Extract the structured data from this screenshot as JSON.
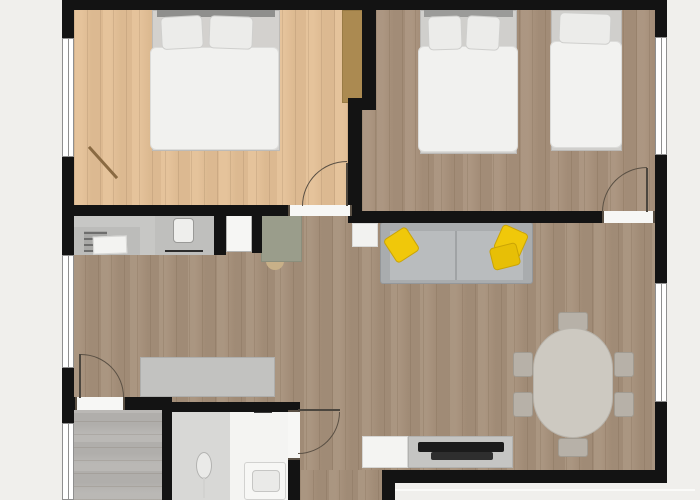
{
  "palette": {
    "background": "#f0efec",
    "wall": "#131313",
    "window_fill": "#ffffff",
    "window_line": "#8f8f8f",
    "threshold_fill": "#f7f7f5",
    "door_line": "#5a5044",
    "floor_wood_light": "#e4c096",
    "floor_wood_dark": "#a6907a",
    "floor_tile_gray": "#b6b4b1",
    "accent_yellow": "#f0c80a"
  },
  "elements": [
    {
      "n": "floor-bedroom-1",
      "t": "floor",
      "x": 74,
      "y": 10,
      "w": 290,
      "h": 196,
      "c": "#e4c096"
    },
    {
      "n": "floor-bedroom-2",
      "t": "floor",
      "x": 376,
      "y": 10,
      "w": 281,
      "h": 203,
      "c": "#a8917b"
    },
    {
      "n": "floor-bedroom-2-strip",
      "t": "floor",
      "x": 362,
      "y": 110,
      "w": 14,
      "h": 103,
      "c": "#a8917b"
    },
    {
      "n": "floor-living-room",
      "t": "floor",
      "x": 72,
      "y": 216,
      "w": 585,
      "h": 254,
      "c": "#a6907a"
    },
    {
      "n": "floor-hallway-strip",
      "t": "floor",
      "x": 300,
      "y": 470,
      "w": 82,
      "h": 30,
      "c": "#a6907a"
    },
    {
      "n": "floor-entry-room",
      "t": "floor",
      "x": 72,
      "y": 410,
      "w": 90,
      "h": 90,
      "c": "#b6b4b1",
      "d": "h"
    },
    {
      "n": "floor-bathroom",
      "t": "rect",
      "x": 172,
      "y": 412,
      "w": 118,
      "h": 88,
      "c": "#d8d8d6"
    },
    {
      "n": "floor-shower-area",
      "t": "rect",
      "x": 230,
      "y": 412,
      "w": 60,
      "h": 88,
      "c": "#f4f4f2"
    },
    {
      "n": "wardrobe",
      "t": "rect",
      "x": 342,
      "y": 10,
      "w": 22,
      "h": 93,
      "c": "#ab8a51",
      "b": "#997b45"
    },
    {
      "n": "double-bed-1-frame",
      "t": "rect",
      "x": 152,
      "y": 10,
      "w": 128,
      "h": 141,
      "c": "#d3d1ce",
      "b": "#bdbbb8"
    },
    {
      "n": "double-bed-1-headboard",
      "t": "rect",
      "x": 157,
      "y": 10,
      "w": 118,
      "h": 7,
      "c": "#8f8f8d"
    },
    {
      "n": "double-bed-1-duvet",
      "t": "rect",
      "x": 150,
      "y": 47,
      "w": 129,
      "h": 103,
      "c": "#f1f1ef",
      "b": "#dcdcda",
      "r": 6
    },
    {
      "n": "double-bed-1-pillow-left",
      "t": "rect",
      "x": 161,
      "y": 16,
      "w": 42,
      "h": 33,
      "c": "#ececea",
      "b": "#cfcfcd",
      "r": 5,
      "rot": -3
    },
    {
      "n": "double-bed-1-pillow-right",
      "t": "rect",
      "x": 209,
      "y": 16,
      "w": 44,
      "h": 33,
      "c": "#ececea",
      "b": "#cfcfcd",
      "r": 5,
      "rot": 2
    },
    {
      "n": "floor-lamp-stick",
      "t": "line",
      "x": 82,
      "y": 161,
      "w": 42,
      "h": 3,
      "c": "#8a6a42",
      "rot": 48
    },
    {
      "n": "double-bed-2-frame",
      "t": "rect",
      "x": 420,
      "y": 10,
      "w": 97,
      "h": 144,
      "c": "#d0cfcc",
      "b": "#bbb9b6"
    },
    {
      "n": "double-bed-2-headboard",
      "t": "rect",
      "x": 424,
      "y": 10,
      "w": 89,
      "h": 7,
      "c": "#9b9b99"
    },
    {
      "n": "double-bed-2-duvet",
      "t": "rect",
      "x": 418,
      "y": 46,
      "w": 100,
      "h": 106,
      "c": "#f1f1ef",
      "b": "#dcdcda",
      "r": 6
    },
    {
      "n": "double-bed-2-pillow-left",
      "t": "rect",
      "x": 428,
      "y": 16,
      "w": 34,
      "h": 34,
      "c": "#ececea",
      "b": "#cfcfcd",
      "r": 5,
      "rot": -2
    },
    {
      "n": "double-bed-2-pillow-right",
      "t": "rect",
      "x": 466,
      "y": 16,
      "w": 34,
      "h": 34,
      "c": "#ececea",
      "b": "#cfcfcd",
      "r": 5,
      "rot": 3
    },
    {
      "n": "single-bed-frame",
      "t": "rect",
      "x": 551,
      "y": 10,
      "w": 71,
      "h": 141,
      "c": "#d0cfcc",
      "b": "#bbb9b6"
    },
    {
      "n": "single-bed-duvet",
      "t": "rect",
      "x": 550,
      "y": 41,
      "w": 72,
      "h": 107,
      "c": "#f2f2f0",
      "b": "#dcdcda",
      "r": 6
    },
    {
      "n": "single-bed-pillow",
      "t": "rect",
      "x": 559,
      "y": 13,
      "w": 52,
      "h": 31,
      "c": "#ececea",
      "b": "#cfcfcd",
      "r": 5,
      "rot": 2
    },
    {
      "n": "kitchen-counter",
      "t": "rect",
      "x": 74,
      "y": 215,
      "w": 140,
      "h": 40,
      "c": "#c7c7c5"
    },
    {
      "n": "kitchen-counter-lower",
      "t": "rect",
      "x": 74,
      "y": 227,
      "w": 66,
      "h": 28,
      "c": "#bcbcba"
    },
    {
      "n": "kitchen-appliance",
      "t": "stripes",
      "x": 84,
      "y": 231,
      "w": 23,
      "h": 21,
      "c": "#a9a9a7",
      "c2": "rgba(0,0,0,0.35)"
    },
    {
      "n": "kitchen-towel",
      "t": "rect",
      "x": 93,
      "y": 236,
      "w": 34,
      "h": 18,
      "c": "#f3f3f1",
      "b": "#d8d8d6",
      "rot": -2
    },
    {
      "n": "kitchen-sink-unit",
      "t": "rect",
      "x": 155,
      "y": 215,
      "w": 59,
      "h": 40,
      "c": "#bfbfbd"
    },
    {
      "n": "kitchen-sink",
      "t": "rect",
      "x": 173,
      "y": 218,
      "w": 21,
      "h": 25,
      "c": "#eeeeec",
      "b": "#9a9a98",
      "r": 4
    },
    {
      "n": "kitchen-oven-handle",
      "t": "rect",
      "x": 165,
      "y": 250,
      "w": 38,
      "h": 2,
      "c": "#2b2b2b"
    },
    {
      "n": "kitchen-tall-unit",
      "t": "rect",
      "x": 226,
      "y": 215,
      "w": 26,
      "h": 37,
      "c": "#f6f6f4",
      "b": "#b4b4b2"
    },
    {
      "n": "desk-chair",
      "t": "ellipse",
      "x": 266,
      "y": 252,
      "w": 18,
      "h": 18,
      "c": "#c8b088"
    },
    {
      "n": "desk",
      "t": "rect",
      "x": 261,
      "y": 215,
      "w": 41,
      "h": 47,
      "c": "#9a9d8b",
      "b": "#8b8e7c"
    },
    {
      "n": "side-table",
      "t": "rect",
      "x": 352,
      "y": 223,
      "w": 26,
      "h": 24,
      "c": "#f2f2f0",
      "b": "#d9d9d7"
    },
    {
      "n": "sofa-body",
      "t": "rect",
      "x": 380,
      "y": 222,
      "w": 153,
      "h": 62,
      "c": "#a9acae",
      "b": "#94979a",
      "r": 3
    },
    {
      "n": "sofa-seat",
      "t": "rect",
      "x": 390,
      "y": 231,
      "w": 133,
      "h": 49,
      "c": "#b9bcbe"
    },
    {
      "n": "sofa-seat-divider",
      "t": "rect",
      "x": 455,
      "y": 231,
      "w": 2,
      "h": 49,
      "c": "#a0a3a5"
    },
    {
      "n": "sofa-pillow-left",
      "t": "rect",
      "x": 388,
      "y": 231,
      "w": 27,
      "h": 28,
      "c": "#f0c80a",
      "b": "#caa405",
      "r": 4,
      "rot": -33
    },
    {
      "n": "sofa-pillow-right-1",
      "t": "rect",
      "x": 497,
      "y": 228,
      "w": 28,
      "h": 27,
      "c": "#f0c80a",
      "b": "#caa405",
      "r": 4,
      "rot": 24
    },
    {
      "n": "sofa-pillow-right-2",
      "t": "rect",
      "x": 491,
      "y": 245,
      "w": 28,
      "h": 23,
      "c": "#e7bf06",
      "b": "#caa405",
      "r": 4,
      "rot": -14
    },
    {
      "n": "sideboard",
      "t": "rect",
      "x": 140,
      "y": 357,
      "w": 135,
      "h": 40,
      "c": "#c2c2c0",
      "b": "#aeaeac"
    },
    {
      "n": "tv-stand-left",
      "t": "rect",
      "x": 362,
      "y": 436,
      "w": 46,
      "h": 32,
      "c": "#f4f4f2",
      "b": "#d6d6d4"
    },
    {
      "n": "tv-stand",
      "t": "rect",
      "x": 408,
      "y": 436,
      "w": 105,
      "h": 32,
      "c": "#c5c5c3",
      "b": "#b2b2b0"
    },
    {
      "n": "tv-screen",
      "t": "rect",
      "x": 418,
      "y": 442,
      "w": 86,
      "h": 10,
      "c": "#1b1b1b",
      "r": 2
    },
    {
      "n": "tv-base",
      "t": "rect",
      "x": 431,
      "y": 452,
      "w": 62,
      "h": 8,
      "c": "#2e2e2e",
      "r": 2
    },
    {
      "n": "dining-chair-top",
      "t": "rect",
      "x": 558,
      "y": 312,
      "w": 30,
      "h": 19,
      "c": "#b7b1a8",
      "b": "#a19b91",
      "r": 3
    },
    {
      "n": "dining-chair-bottom",
      "t": "rect",
      "x": 558,
      "y": 438,
      "w": 30,
      "h": 19,
      "c": "#b7b1a8",
      "b": "#a19b91",
      "r": 3
    },
    {
      "n": "dining-chair-left-1",
      "t": "rect",
      "x": 513,
      "y": 352,
      "w": 20,
      "h": 25,
      "c": "#b7b1a8",
      "b": "#a19b91",
      "r": 3
    },
    {
      "n": "dining-chair-left-2",
      "t": "rect",
      "x": 513,
      "y": 392,
      "w": 20,
      "h": 25,
      "c": "#b7b1a8",
      "b": "#a19b91",
      "r": 3
    },
    {
      "n": "dining-chair-right-1",
      "t": "rect",
      "x": 614,
      "y": 352,
      "w": 20,
      "h": 25,
      "c": "#b7b1a8",
      "b": "#a19b91",
      "r": 3
    },
    {
      "n": "dining-chair-right-2",
      "t": "rect",
      "x": 614,
      "y": 392,
      "w": 20,
      "h": 25,
      "c": "#b7b1a8",
      "b": "#a19b91",
      "r": 3
    },
    {
      "n": "dining-table",
      "t": "rect",
      "x": 533,
      "y": 328,
      "w": 80,
      "h": 110,
      "c": "#cdc9c1",
      "b": "#b8b4ac",
      "r": 40
    },
    {
      "n": "shower-head",
      "t": "ellipse",
      "x": 196,
      "y": 452,
      "w": 16,
      "h": 27,
      "c": "#eaeae8",
      "b": "#b3b3b1"
    },
    {
      "n": "shower-hose",
      "t": "rect",
      "x": 203,
      "y": 477,
      "w": 2,
      "h": 21,
      "c": "#d2d2d0"
    },
    {
      "n": "shower-screen-handle",
      "t": "rect",
      "x": 254,
      "y": 410,
      "w": 18,
      "h": 3,
      "c": "#3f3f3f"
    },
    {
      "n": "bath-vanity",
      "t": "rect",
      "x": 244,
      "y": 462,
      "w": 42,
      "h": 38,
      "c": "#f7f7f5",
      "b": "#d2d2d0",
      "r": 3
    },
    {
      "n": "bath-basin",
      "t": "rect",
      "x": 252,
      "y": 470,
      "w": 28,
      "h": 22,
      "c": "#eaeae8",
      "b": "#c6c6c4",
      "r": 4
    },
    {
      "n": "wall-top",
      "t": "wall",
      "x": 62,
      "y": 0,
      "w": 605,
      "h": 10
    },
    {
      "n": "wall-left-upper",
      "t": "wall",
      "x": 62,
      "y": 10,
      "w": 12,
      "h": 28
    },
    {
      "n": "wall-left-mid",
      "t": "wall",
      "x": 62,
      "y": 157,
      "w": 12,
      "h": 98
    },
    {
      "n": "wall-left-lower",
      "t": "wall",
      "x": 62,
      "y": 368,
      "w": 12,
      "h": 55
    },
    {
      "n": "wall-right-upper",
      "t": "wall",
      "x": 655,
      "y": 10,
      "w": 12,
      "h": 27
    },
    {
      "n": "wall-right-mid",
      "t": "wall",
      "x": 655,
      "y": 155,
      "w": 12,
      "h": 128
    },
    {
      "n": "wall-right-lower",
      "t": "wall",
      "x": 655,
      "y": 402,
      "w": 12,
      "h": 81
    },
    {
      "n": "wall-bedroom1-bottom",
      "t": "wall",
      "x": 62,
      "y": 205,
      "w": 228,
      "h": 11
    },
    {
      "n": "wall-bedroom2-bottom",
      "t": "wall",
      "x": 348,
      "y": 211,
      "w": 254,
      "h": 12
    },
    {
      "n": "wall-between-bedrooms",
      "t": "wall",
      "x": 362,
      "y": 0,
      "w": 14,
      "h": 110
    },
    {
      "n": "wall-step",
      "t": "wall",
      "x": 348,
      "y": 98,
      "w": 28,
      "h": 12
    },
    {
      "n": "wall-bedroom1-living",
      "t": "wall",
      "x": 348,
      "y": 98,
      "w": 14,
      "h": 125
    },
    {
      "n": "wall-kitchen-stub-left",
      "t": "wall",
      "x": 214,
      "y": 213,
      "w": 12,
      "h": 42
    },
    {
      "n": "wall-kitchen-stub-right",
      "t": "wall",
      "x": 252,
      "y": 213,
      "w": 10,
      "h": 40
    },
    {
      "n": "wall-entry-left",
      "t": "wall",
      "x": 62,
      "y": 397,
      "w": 13,
      "h": 13
    },
    {
      "n": "wall-entry-right",
      "t": "wall",
      "x": 125,
      "y": 397,
      "w": 47,
      "h": 13
    },
    {
      "n": "wall-bathroom-top",
      "t": "wall",
      "x": 162,
      "y": 402,
      "w": 138,
      "h": 10
    },
    {
      "n": "wall-entry-bathroom",
      "t": "wall",
      "x": 162,
      "y": 410,
      "w": 10,
      "h": 90
    },
    {
      "n": "wall-bathroom-right-lower",
      "t": "wall",
      "x": 288,
      "y": 458,
      "w": 12,
      "h": 42
    },
    {
      "n": "wall-bottom",
      "t": "wall",
      "x": 382,
      "y": 470,
      "w": 278,
      "h": 13
    },
    {
      "n": "wall-bottom-stub",
      "t": "wall",
      "x": 382,
      "y": 483,
      "w": 13,
      "h": 17
    },
    {
      "n": "window-bedroom1",
      "t": "window",
      "x": 62,
      "y": 38,
      "w": 12,
      "h": 119
    },
    {
      "n": "window-living-left",
      "t": "window",
      "x": 62,
      "y": 255,
      "w": 12,
      "h": 113
    },
    {
      "n": "window-entry-room",
      "t": "window",
      "x": 62,
      "y": 423,
      "w": 12,
      "h": 77
    },
    {
      "n": "window-bedroom2",
      "t": "window",
      "x": 655,
      "y": 37,
      "w": 12,
      "h": 118
    },
    {
      "n": "window-dining",
      "t": "window",
      "x": 655,
      "y": 283,
      "w": 12,
      "h": 119
    },
    {
      "n": "threshold-bedroom1-door",
      "t": "threshold",
      "x": 288,
      "y": 205,
      "w": 64,
      "h": 11
    },
    {
      "n": "threshold-bedroom2-door",
      "t": "threshold",
      "x": 602,
      "y": 211,
      "w": 53,
      "h": 12
    },
    {
      "n": "threshold-entry-door",
      "t": "threshold",
      "x": 75,
      "y": 397,
      "w": 50,
      "h": 13
    },
    {
      "n": "threshold-bathroom-door",
      "t": "threshold",
      "x": 288,
      "y": 410,
      "w": 12,
      "h": 50
    },
    {
      "n": "door-bedroom1-leaf",
      "t": "line",
      "x": 346,
      "y": 163,
      "w": 2,
      "h": 43,
      "c": "#4c463e"
    },
    {
      "n": "door-bedroom1-swing-arc",
      "t": "arc",
      "x": 302,
      "y": 161,
      "w": 45,
      "h": 45,
      "cr": "tl"
    },
    {
      "n": "door-bedroom2-leaf",
      "t": "line",
      "x": 646,
      "y": 168,
      "w": 2,
      "h": 44,
      "c": "#4c463e"
    },
    {
      "n": "door-bedroom2-swing-arc",
      "t": "arc",
      "x": 602,
      "y": 167,
      "w": 45,
      "h": 45,
      "cr": "tl"
    },
    {
      "n": "door-entry-leaf",
      "t": "line",
      "x": 79,
      "y": 354,
      "w": 2,
      "h": 44,
      "c": "#4c463e"
    },
    {
      "n": "door-entry-swing-arc",
      "t": "arc",
      "x": 81,
      "y": 354,
      "w": 43,
      "h": 43,
      "cr": "tr"
    },
    {
      "n": "door-bathroom-leaf",
      "t": "line",
      "x": 298,
      "y": 409,
      "w": 42,
      "h": 2,
      "c": "#4c463e"
    },
    {
      "n": "door-bathroom-swing-arc",
      "t": "arc",
      "x": 298,
      "y": 412,
      "w": 42,
      "h": 42,
      "cr": "br"
    },
    {
      "n": "terrace-edge",
      "t": "rect",
      "x": 395,
      "y": 489,
      "w": 300,
      "h": 2,
      "c": "#fafaf8"
    }
  ]
}
